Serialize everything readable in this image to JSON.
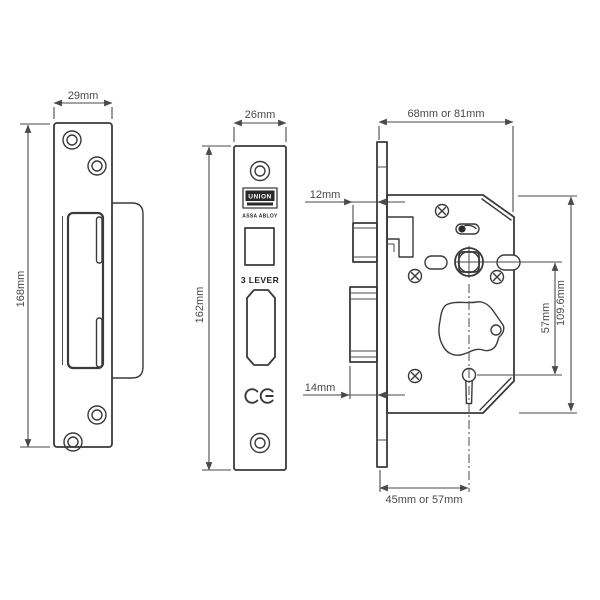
{
  "drawing_title": "Mortice sashlock technical drawing - three views",
  "colors": {
    "line": "#3a3a3a",
    "dimension": "#4a4a4a",
    "background": "#ffffff",
    "badge_fill": "#2a2a2a"
  },
  "views": {
    "strike_plate": {
      "name": "strike plate with box keep",
      "width_label": "29mm",
      "height_label": "168mm"
    },
    "faceplate": {
      "name": "lock faceplate front view",
      "width_label": "26mm",
      "height_label": "162mm",
      "brand": "UNION",
      "brand_sub": "ASSA ABLOY",
      "lever_text": "3 LEVER",
      "ce_mark": "CE"
    },
    "lock_case": {
      "name": "lock case side view",
      "case_depth_label": "68mm or 81mm",
      "latch_projection_label": "12mm",
      "deadbolt_projection_label": "14mm",
      "follower_to_keyhole_label": "57mm",
      "case_height_label": "109.6mm",
      "backset_label": "45mm or 57mm"
    }
  }
}
